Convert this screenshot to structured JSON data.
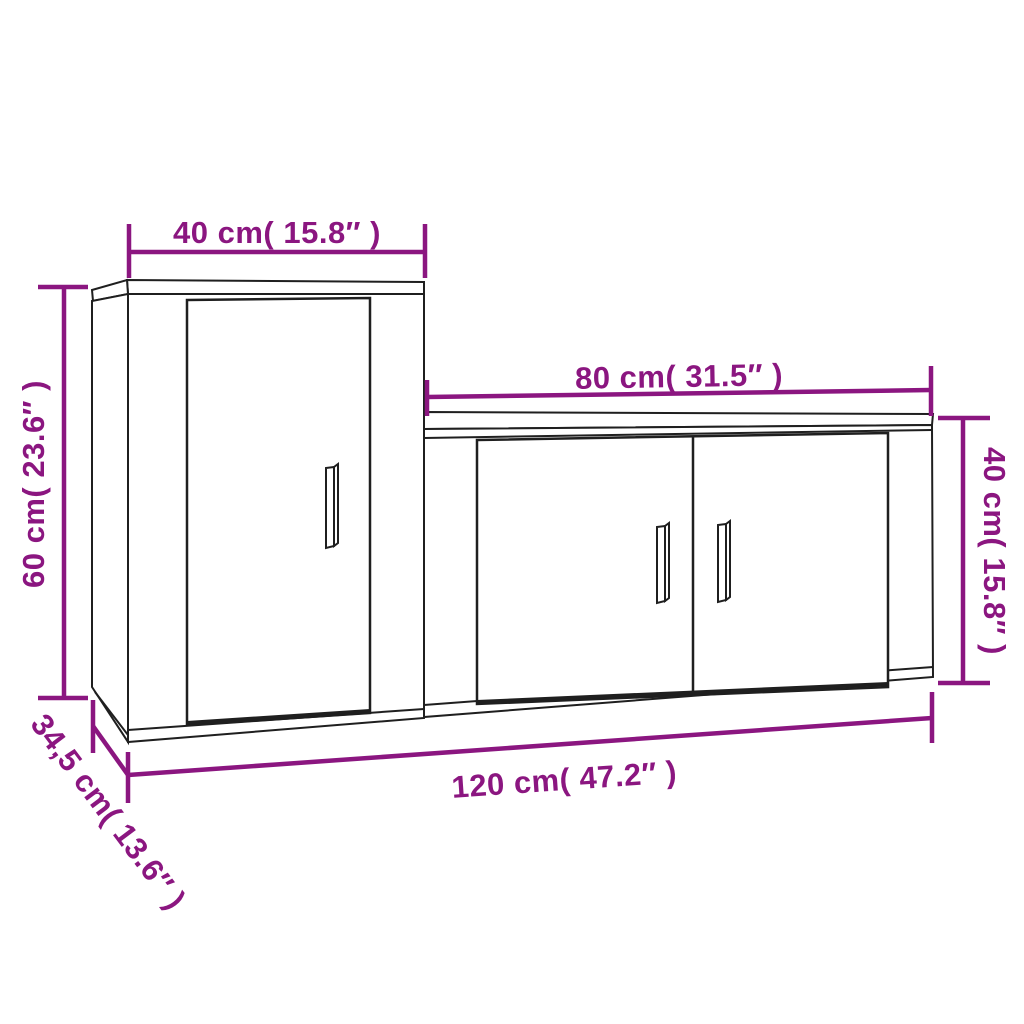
{
  "diagram": {
    "type": "furniture-dimension-diagram",
    "subject": "2-piece TV cabinet set (tall wall cabinet + low TV bench)",
    "colors": {
      "dimension": "#8b1680",
      "outline": "#1f1f1f",
      "background": "#ffffff"
    },
    "dimensions": {
      "tall_cabinet_width": {
        "label": "40 cm( 15.8″ )",
        "cm": 40,
        "inches": 15.8
      },
      "tall_cabinet_height": {
        "label": "60 cm( 23.6″ )",
        "cm": 60,
        "inches": 23.6
      },
      "tall_cabinet_depth": {
        "label": "34,5 cm( 13.6″ )",
        "cm": 34.5,
        "inches": 13.6
      },
      "low_cabinet_width": {
        "label": "80 cm( 31.5″ )",
        "cm": 80,
        "inches": 31.5
      },
      "low_cabinet_height": {
        "label": "40 cm( 15.8″ )",
        "cm": 40,
        "inches": 15.8
      },
      "total_width": {
        "label": "120 cm( 47.2″ )",
        "cm": 120,
        "inches": 47.2
      }
    }
  }
}
